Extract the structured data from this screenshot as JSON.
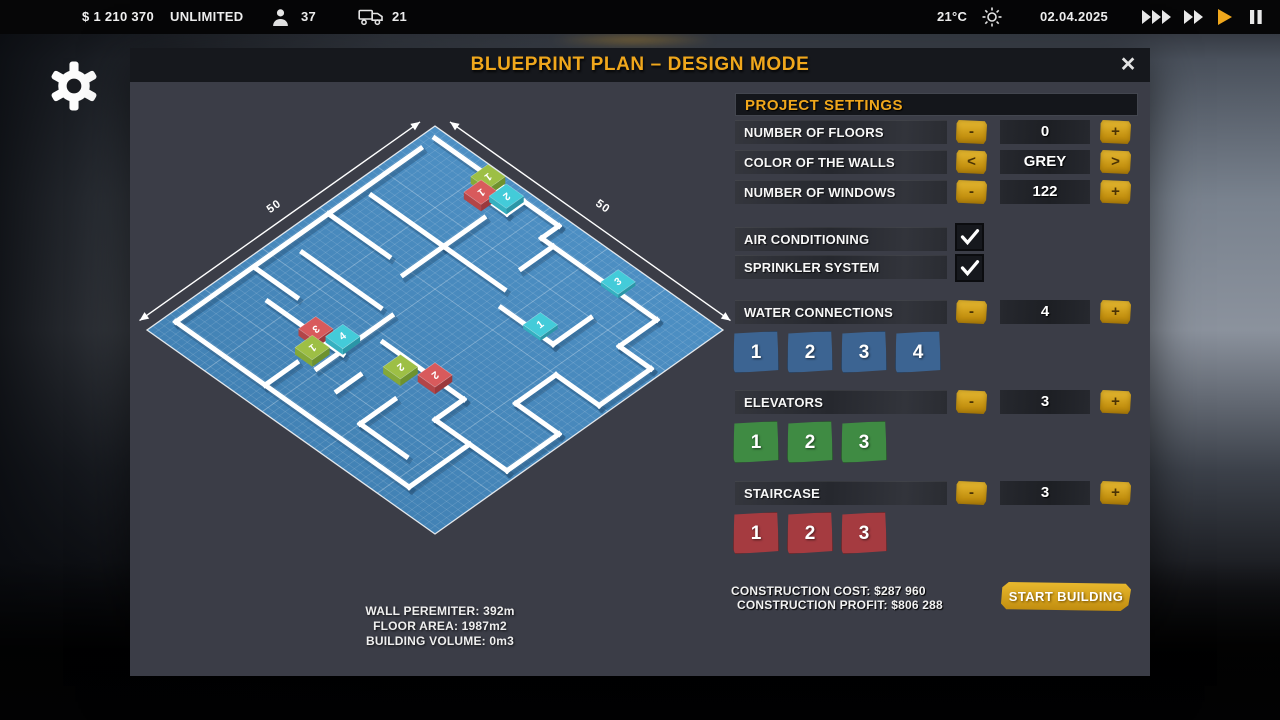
{
  "top_bar": {
    "money": "$ 1 210 370",
    "limit": "UNLIMITED",
    "workers": "37",
    "trucks": "21",
    "temperature": "21°C",
    "date": "02.04.2025",
    "accent": "#f0a71c"
  },
  "modal": {
    "title": "BLUEPRINT PLAN – DESIGN MODE",
    "close": "×"
  },
  "blueprint": {
    "dimension_left": "50",
    "dimension_right": "50",
    "floor_color_top": "#5295ca",
    "floor_color_bottom": "#3d7cae",
    "walls": [
      [
        1.5,
        1.5,
        13,
        1.5
      ],
      [
        13,
        1.5,
        13,
        4.5
      ],
      [
        13,
        4.5,
        17,
        4.5
      ],
      [
        17,
        4.5,
        17,
        1.5
      ],
      [
        17,
        1.5,
        23,
        1.5
      ],
      [
        23,
        1.5,
        23,
        4.5
      ],
      [
        23,
        4.5,
        43,
        4.5
      ],
      [
        43,
        4.5,
        43,
        11
      ],
      [
        43,
        11,
        48.5,
        11
      ],
      [
        48.5,
        11,
        48.5,
        20
      ],
      [
        48.5,
        20,
        41,
        20
      ],
      [
        41,
        20,
        41,
        27
      ],
      [
        41,
        27,
        48.5,
        27
      ],
      [
        48.5,
        27,
        48.5,
        36
      ],
      [
        48.5,
        36,
        36,
        36
      ],
      [
        42,
        36,
        42,
        46.5
      ],
      [
        42,
        46.5,
        1.5,
        46.5
      ],
      [
        1.5,
        4,
        1.5,
        46.5
      ],
      [
        3,
        14,
        26,
        14
      ],
      [
        15.5,
        7,
        15.5,
        14
      ],
      [
        15.5,
        14,
        15.5,
        21
      ],
      [
        1.5,
        20,
        12,
        20
      ],
      [
        28,
        16.5,
        37,
        16.5
      ],
      [
        37,
        16.5,
        37,
        10
      ],
      [
        25,
        4.5,
        25,
        10
      ],
      [
        4,
        27,
        17.5,
        27
      ],
      [
        2,
        33,
        9,
        33
      ],
      [
        19.5,
        27,
        19.5,
        40
      ],
      [
        7,
        36,
        20,
        36
      ],
      [
        22,
        31,
        36,
        31
      ],
      [
        36,
        31,
        36,
        36
      ],
      [
        30,
        37,
        30,
        43
      ],
      [
        30,
        43,
        38,
        43
      ],
      [
        17,
        41,
        17,
        46.5
      ],
      [
        24,
        37,
        24,
        41
      ]
    ],
    "markers": [
      {
        "u": 10.8,
        "v": 1.6,
        "label": "1",
        "color": "green",
        "type": "elevator",
        "rot": 143,
        "h": 7
      },
      {
        "u": 12.1,
        "v": 4.1,
        "label": "1",
        "color": "red",
        "type": "staircase",
        "rot": 143,
        "h": 7
      },
      {
        "u": 14.8,
        "v": 2.4,
        "label": "2",
        "color": "cyan",
        "type": "water-connection",
        "rot": 143,
        "h": 6
      },
      {
        "u": 35,
        "v": 3.2,
        "label": "3",
        "color": "cyan",
        "type": "water-connection",
        "rot": -37,
        "h": 4
      },
      {
        "u": 33.5,
        "v": 15.2,
        "label": "1",
        "color": "cyan",
        "type": "water-connection",
        "rot": -37,
        "h": 4
      },
      {
        "u": 14.5,
        "v": 35.2,
        "label": "3",
        "color": "red",
        "type": "staircase",
        "rot": 143,
        "h": 7
      },
      {
        "u": 17.8,
        "v": 33.8,
        "label": "4",
        "color": "cyan",
        "type": "water-connection",
        "rot": -37,
        "h": 6
      },
      {
        "u": 16.5,
        "v": 37.8,
        "label": "1",
        "color": "green",
        "type": "elevator",
        "rot": 143,
        "h": 7
      },
      {
        "u": 26.5,
        "v": 32.5,
        "label": "2",
        "color": "green",
        "type": "elevator",
        "rot": 143,
        "h": 7
      },
      {
        "u": 30.5,
        "v": 30.5,
        "label": "2",
        "color": "red",
        "type": "staircase",
        "rot": 143,
        "h": 7
      }
    ],
    "marker_colors": {
      "red": {
        "top": "#d85a5c",
        "left": "#b24548",
        "right": "#9c383c"
      },
      "green": {
        "top": "#9dbf45",
        "left": "#84a838",
        "right": "#6e922e"
      },
      "cyan": {
        "top": "#43cbd9",
        "left": "#35b0c0",
        "right": "#2a96a7"
      }
    }
  },
  "stats": {
    "wall_perimeter": "WALL PEREMITER: 392m",
    "floor_area": "FLOOR AREA: 1987m2",
    "building_volume": "BUILDING VOLUME: 0m3"
  },
  "settings": {
    "header": "PROJECT SETTINGS",
    "rows": [
      {
        "label": "NUMBER OF FLOORS",
        "minus": "-",
        "value": "0",
        "plus": "+"
      },
      {
        "label": "COLOR OF THE WALLS",
        "minus": "<",
        "value": "GREY",
        "plus": ">"
      },
      {
        "label": "NUMBER OF WINDOWS",
        "minus": "-",
        "value": "122",
        "plus": "+"
      }
    ],
    "toggles": [
      {
        "label": "AIR CONDITIONING",
        "checked": true
      },
      {
        "label": "SPRINKLER SYSTEM",
        "checked": true
      }
    ],
    "counters": [
      {
        "label": "WATER CONNECTIONS",
        "minus": "-",
        "value": "4",
        "plus": "+",
        "tiles": [
          "1",
          "2",
          "3",
          "4"
        ],
        "tile_color": "#3c6492"
      },
      {
        "label": "ELEVATORS",
        "minus": "-",
        "value": "3",
        "plus": "+",
        "tiles": [
          "1",
          "2",
          "3"
        ],
        "tile_color": "#3f8b43"
      },
      {
        "label": "STAIRCASE",
        "minus": "-",
        "value": "3",
        "plus": "+",
        "tiles": [
          "1",
          "2",
          "3"
        ],
        "tile_color": "#a53b40"
      }
    ]
  },
  "footer": {
    "cost": "CONSTRUCTION COST: $287 960",
    "profit": "CONSTRUCTION PROFIT: $806 288",
    "start_button": "START BUILDING",
    "gold": "#d8a21b"
  }
}
